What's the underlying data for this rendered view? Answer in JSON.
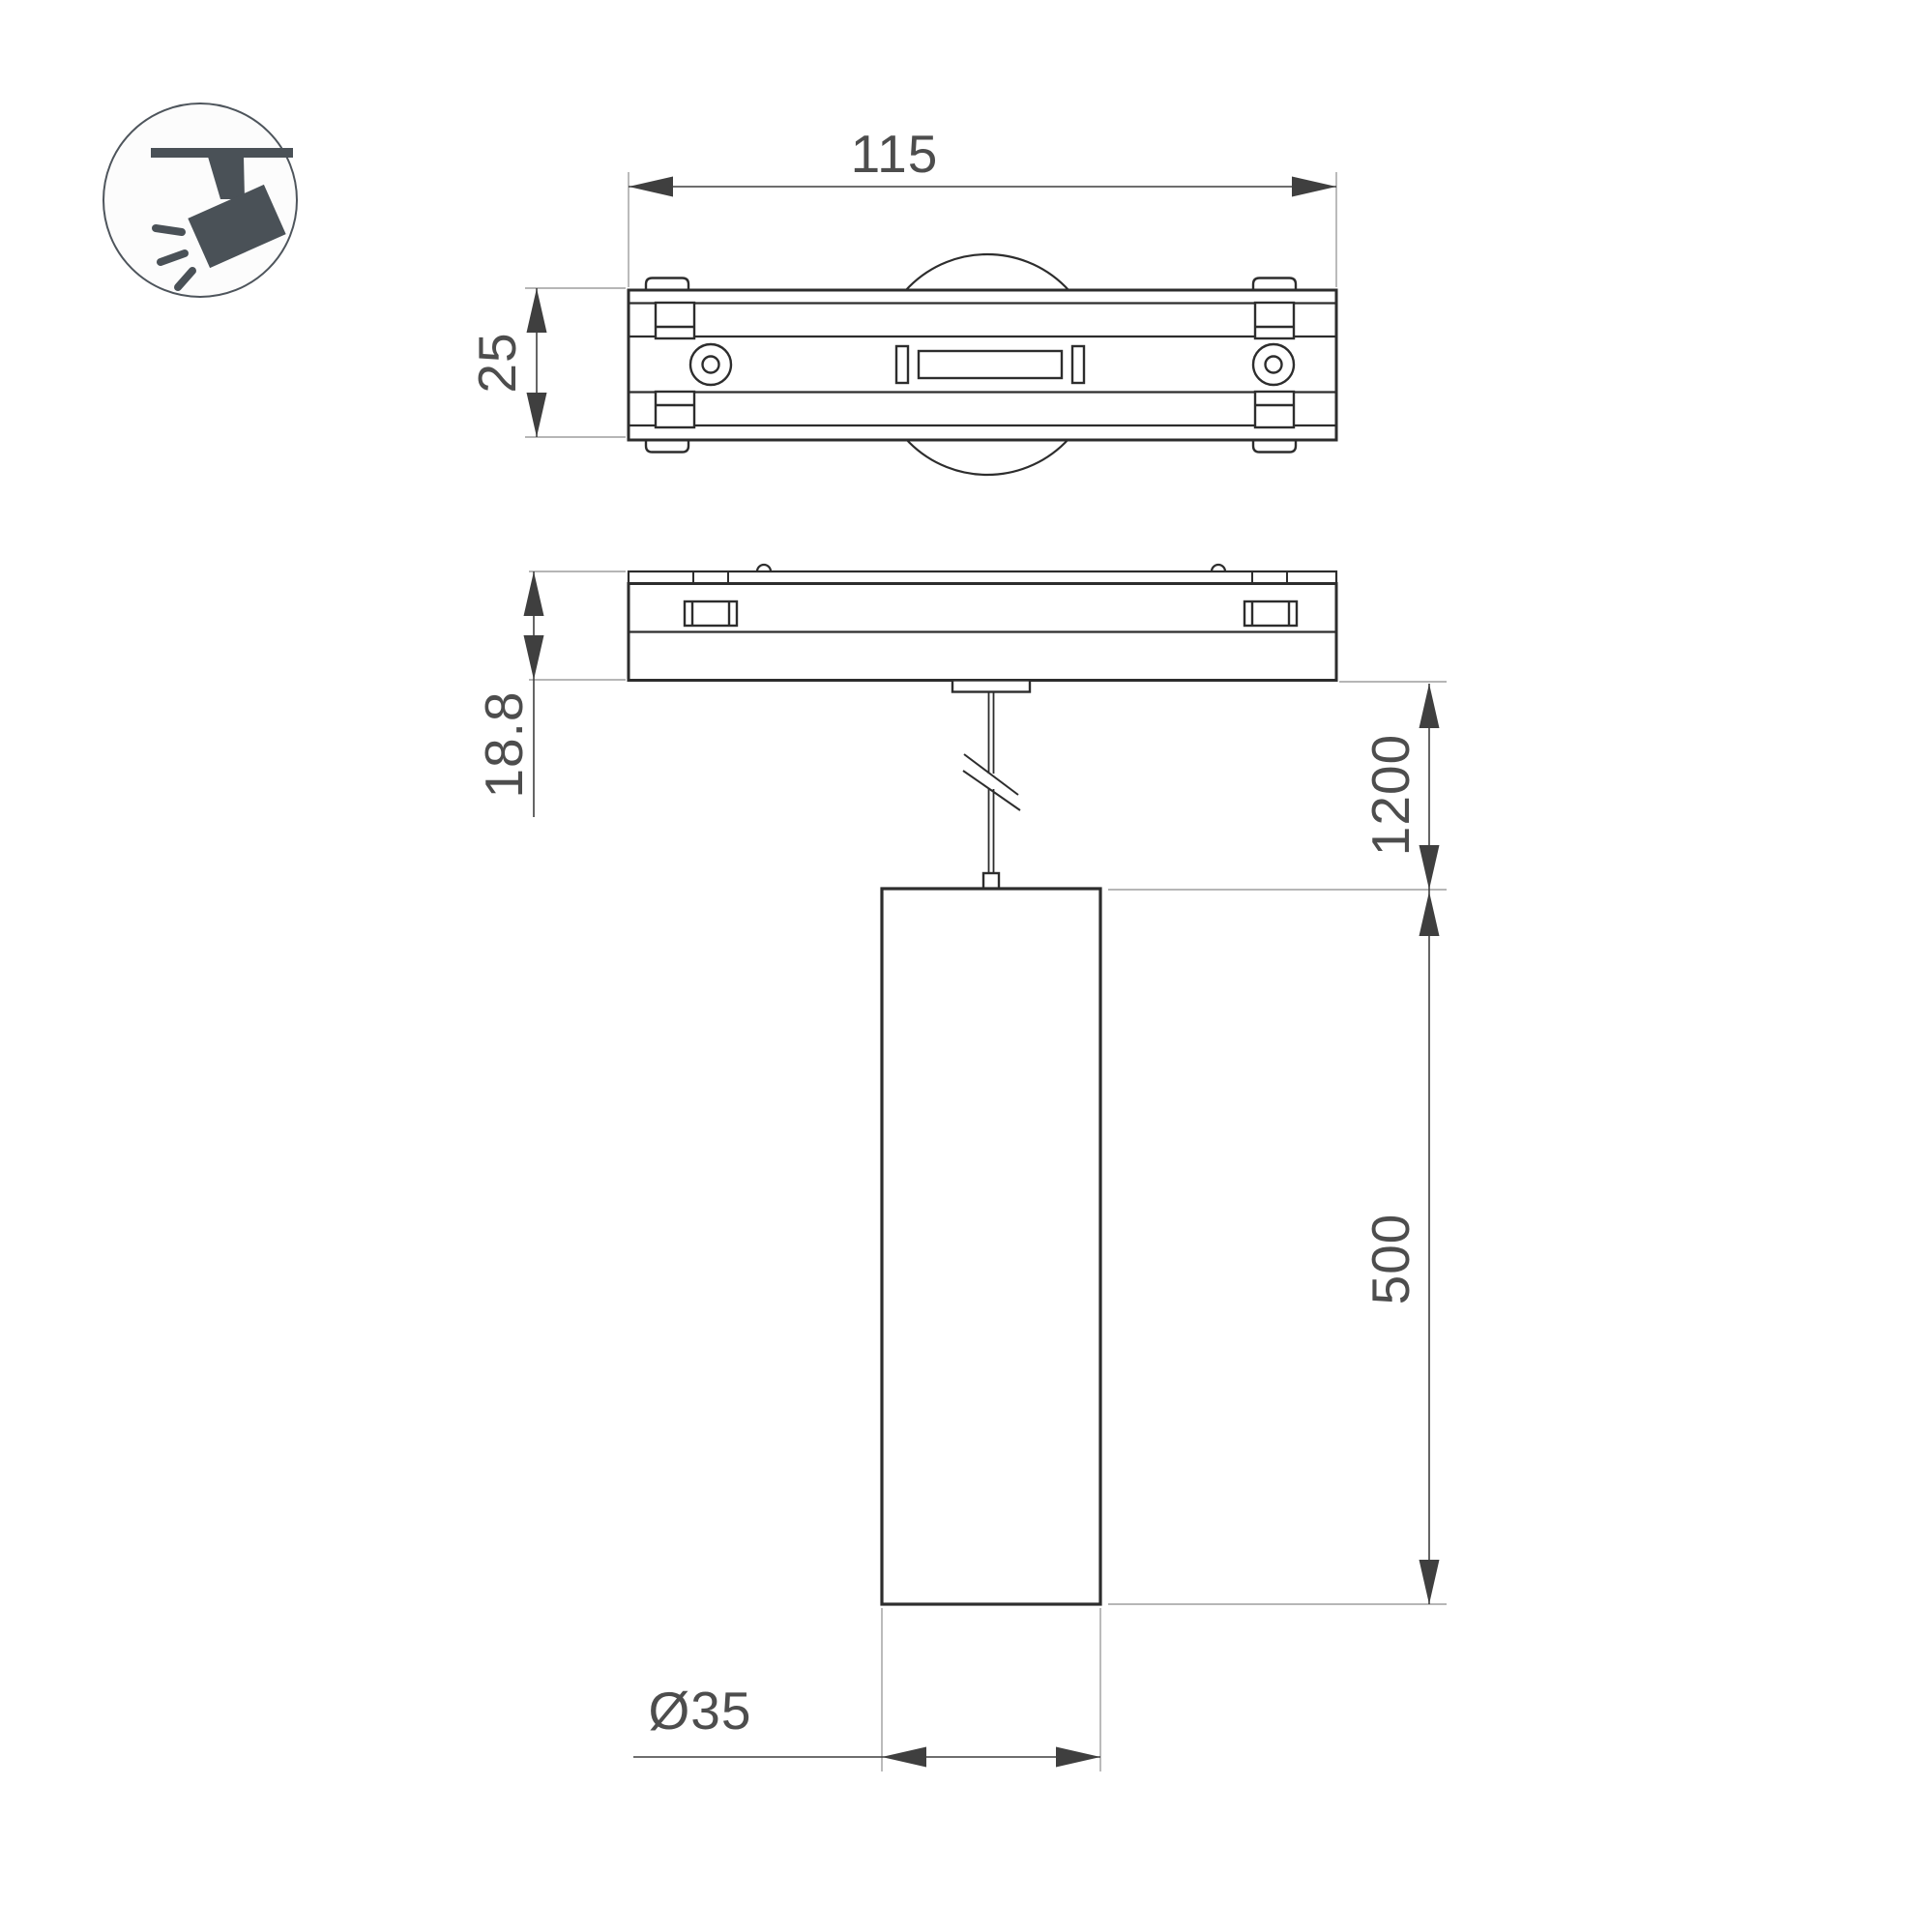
{
  "drawing": {
    "type": "technical-dimension-drawing",
    "subject": "magnetic track pendant spotlight",
    "background": "#ffffff",
    "colors": {
      "geometry_line": "#2d2d2d",
      "dimension_line": "#3f3f3f",
      "extension_line": "#9e9e9e",
      "label_text": "#4d4d4d",
      "icon_fill": "#4a5157"
    },
    "icon": {
      "name": "track-spotlight-icon"
    },
    "dimension_labels": {
      "track_adapter_width": "115",
      "track_adapter_depth": "25",
      "base_height": "18.8",
      "suspension_length": "1200",
      "lamp_body_length": "500",
      "lamp_diameter": "Ø35"
    }
  }
}
